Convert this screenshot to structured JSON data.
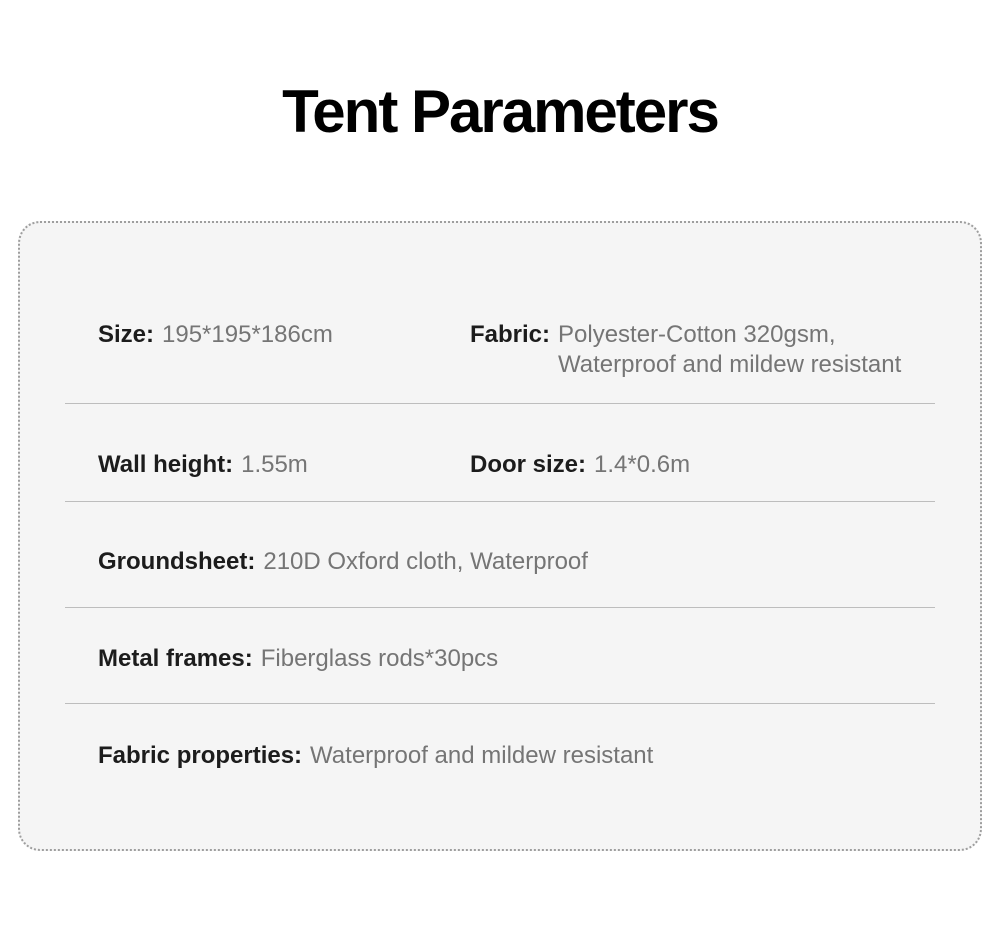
{
  "page": {
    "title": "Tent Parameters"
  },
  "colors": {
    "page_background": "#ffffff",
    "card_background": "#f5f5f5",
    "card_border": "#9e9e9e",
    "divider": "#bdbdbd",
    "label_text": "#1c1c1c",
    "value_text": "#757575",
    "title_text": "#000000"
  },
  "spec_card": {
    "rows": [
      {
        "items": [
          {
            "label": "Size:",
            "value": "195*195*186cm"
          },
          {
            "label": "Fabric:",
            "value": "Polyester-Cotton 320gsm, Waterproof and mildew resistant"
          }
        ]
      },
      {
        "items": [
          {
            "label": "Wall height:",
            "value": "1.55m"
          },
          {
            "label": "Door size:",
            "value": "1.4*0.6m"
          }
        ]
      },
      {
        "items": [
          {
            "label": "Groundsheet:",
            "value": "210D Oxford cloth, Waterproof"
          }
        ]
      },
      {
        "items": [
          {
            "label": "Metal frames:",
            "value": "Fiberglass rods*30pcs"
          }
        ]
      },
      {
        "items": [
          {
            "label": "Fabric properties:",
            "value": "Waterproof and mildew resistant"
          }
        ]
      }
    ]
  }
}
